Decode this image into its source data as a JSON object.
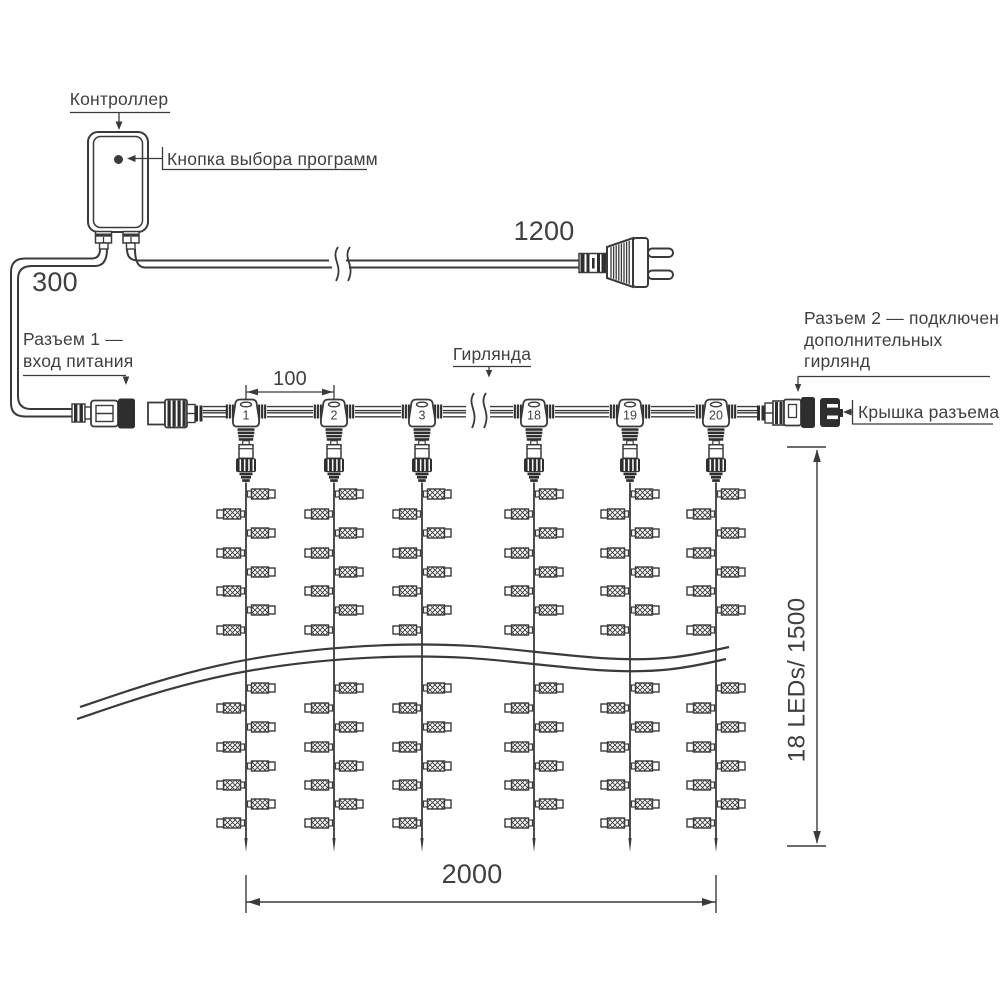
{
  "diagram": {
    "controller_label": "Контроллер",
    "program_button_label": "Кнопка выбора программ",
    "power_lead_length": "300",
    "cord_length": "1200",
    "connector1_line1": "Разъем 1 —",
    "connector1_line2": "вход питания",
    "garland_label": "Гирлянда",
    "drop_spacing": "100",
    "connector2_line1": "Разъем 2 — подключение",
    "connector2_line2": "дополнительных",
    "connector2_line3": "гирлянд",
    "cap_label": "Крышка разъема",
    "curtain_width": "2000",
    "curtain_height": "18 LEDs/ 1500",
    "drops": [
      "1",
      "2",
      "3",
      "18",
      "19",
      "20"
    ],
    "colors": {
      "line": "#3a3a3a",
      "text": "#3f3f3f",
      "dark": "#2e2e2e"
    }
  }
}
